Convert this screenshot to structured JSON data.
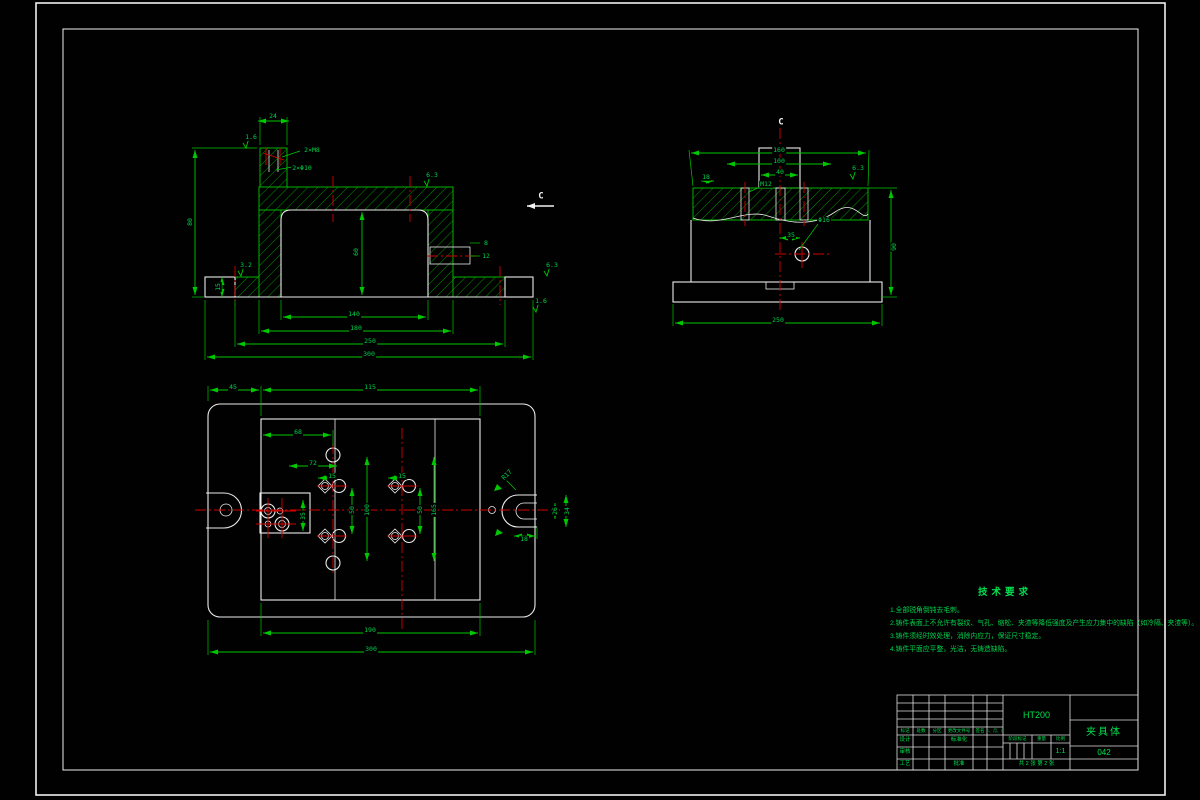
{
  "colors": {
    "line_green": "#00c800",
    "outline_white": "#ececec",
    "centerline_red": "#d40000",
    "text_green": "#00d24b",
    "background": "#010101"
  },
  "section_labels": {
    "cutting_mark": "C",
    "view_title": "C"
  },
  "annotations": [
    {
      "x": 273,
      "y": 116,
      "t": "24"
    },
    {
      "x": 251,
      "y": 137,
      "t": "1.6"
    },
    {
      "x": 312,
      "y": 150,
      "t": "2×M8"
    },
    {
      "x": 302,
      "y": 168,
      "t": "2×Φ10"
    },
    {
      "x": 190,
      "y": 222,
      "t": "80",
      "rot": -90
    },
    {
      "x": 218,
      "y": 287,
      "t": "15",
      "rot": -90
    },
    {
      "x": 356,
      "y": 252,
      "t": "60",
      "rot": -90
    },
    {
      "x": 432,
      "y": 175,
      "t": "6.3"
    },
    {
      "x": 486,
      "y": 243,
      "t": "8"
    },
    {
      "x": 486,
      "y": 256,
      "t": "12"
    },
    {
      "x": 354,
      "y": 314,
      "t": "140"
    },
    {
      "x": 356,
      "y": 328,
      "t": "180"
    },
    {
      "x": 370,
      "y": 341,
      "t": "250"
    },
    {
      "x": 369,
      "y": 354,
      "t": "300"
    },
    {
      "x": 246,
      "y": 265,
      "t": "3.2"
    },
    {
      "x": 552,
      "y": 265,
      "t": "6.3"
    },
    {
      "x": 541,
      "y": 301,
      "t": "1.6"
    },
    {
      "x": 541,
      "y": 197,
      "t": "C",
      "c": "w"
    },
    {
      "x": 781,
      "y": 123,
      "t": "C",
      "c": "w"
    },
    {
      "x": 779,
      "y": 150,
      "t": "160"
    },
    {
      "x": 779,
      "y": 161,
      "t": "100"
    },
    {
      "x": 780,
      "y": 172,
      "t": "40"
    },
    {
      "x": 706,
      "y": 177,
      "t": "18"
    },
    {
      "x": 766,
      "y": 184,
      "t": "M12"
    },
    {
      "x": 858,
      "y": 168,
      "t": "6.3"
    },
    {
      "x": 894,
      "y": 247,
      "t": "90",
      "rot": -90
    },
    {
      "x": 791,
      "y": 235,
      "t": "35"
    },
    {
      "x": 824,
      "y": 220,
      "t": "Φ16"
    },
    {
      "x": 778,
      "y": 320,
      "t": "250"
    },
    {
      "x": 233,
      "y": 387,
      "t": "45"
    },
    {
      "x": 370,
      "y": 387,
      "t": "115"
    },
    {
      "x": 298,
      "y": 432,
      "t": "68"
    },
    {
      "x": 313,
      "y": 463,
      "t": "72"
    },
    {
      "x": 332,
      "y": 476,
      "t": "15"
    },
    {
      "x": 402,
      "y": 476,
      "t": "15"
    },
    {
      "x": 352,
      "y": 510,
      "t": "50",
      "rot": -90
    },
    {
      "x": 367,
      "y": 510,
      "t": "100",
      "rot": -90
    },
    {
      "x": 420,
      "y": 510,
      "t": "50",
      "rot": -90
    },
    {
      "x": 434,
      "y": 510,
      "t": "165",
      "rot": -90
    },
    {
      "x": 303,
      "y": 516,
      "t": "35",
      "rot": -90
    },
    {
      "x": 507,
      "y": 475,
      "t": "R17",
      "rot": -45
    },
    {
      "x": 555,
      "y": 511,
      "t": "26",
      "rot": -90
    },
    {
      "x": 567,
      "y": 511,
      "t": "34",
      "rot": -90
    },
    {
      "x": 524,
      "y": 539,
      "t": "18"
    },
    {
      "x": 370,
      "y": 630,
      "t": "190"
    },
    {
      "x": 371,
      "y": 649,
      "t": "300"
    }
  ],
  "tech_notes": {
    "title": "技术要求",
    "lines": [
      "1.全部锐角倒钝去毛刺。",
      "2.铸件表面上不允许有裂纹、气孔、缩松、夹渣等降低强度及产生应力集中的缺陷（如冷隔、夹渣等）。",
      "3.铸件须经时效处理，消除内应力，保证尺寸稳定。",
      "4.铸件平面应平整，光洁，无铸造缺陷。"
    ]
  },
  "titleblock": {
    "material": "HT200",
    "part_name": "夹具体",
    "drawing_no": "042",
    "scale_value": "1:1",
    "sheet_info": "共 2 张  第 2 张",
    "headers": [
      "标记",
      "处数",
      "分区",
      "更改文件号",
      "签名",
      "年、月、日"
    ],
    "labels": {
      "design": "设计",
      "standardize": "标准化",
      "check": "审核",
      "process": "工艺",
      "approve": "批准",
      "stage": "阶段标记",
      "weight": "重量",
      "scale": "比例"
    }
  }
}
